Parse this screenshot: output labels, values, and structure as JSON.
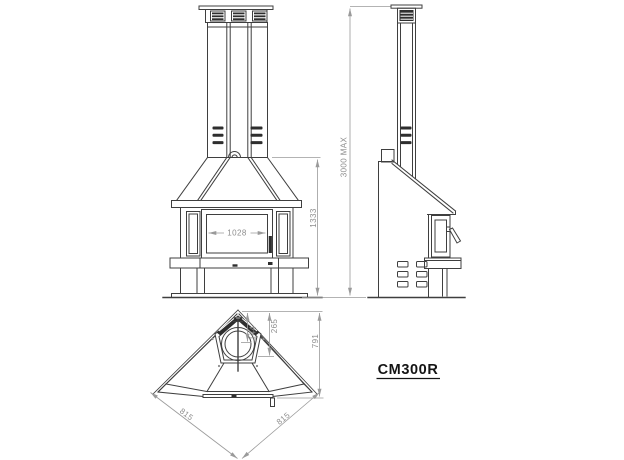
{
  "model_label": "CM300R",
  "dimensions": {
    "door_width": "1028",
    "front_height": "1333",
    "max_total_height": "3000 MAX",
    "plan_flue_inner": "144",
    "plan_flue_outer": "265",
    "plan_depth": "791",
    "plan_left_side": "815",
    "plan_right_side": "815"
  },
  "colors": {
    "background": "#ffffff",
    "line": "#3f3f3f",
    "dim_line": "#9a9a9a",
    "dim_text": "#8d8d8d",
    "dark_fill": "#2e2e2e",
    "label_text": "#141414"
  }
}
